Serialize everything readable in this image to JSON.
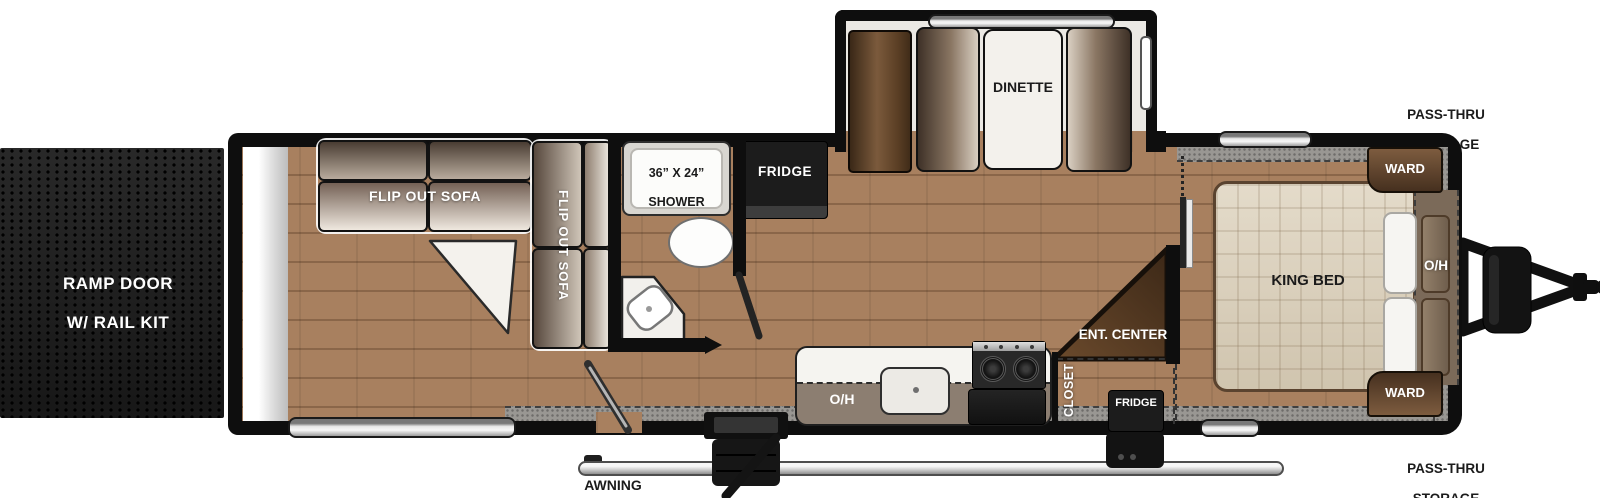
{
  "floorplan": {
    "exterior": {
      "ramp_door_line1": "RAMP DOOR",
      "ramp_door_line2": "W/ RAIL KIT",
      "awning": "AWNING",
      "pass_thru_top_line1": "PASS-THRU",
      "pass_thru_top_line2": "STORAGE",
      "pass_thru_bottom_line1": "PASS-THRU",
      "pass_thru_bottom_line2": "STORAGE"
    },
    "garage": {
      "sofa_horizontal": "FLIP OUT SOFA",
      "sofa_vertical": "FLIP OUT SOFA"
    },
    "bathroom": {
      "shower_line1": "36” X 24”",
      "shower_line2": "SHOWER"
    },
    "kitchen": {
      "fridge": "FRIDGE",
      "pantry": "PANTRY",
      "dinette": "DINETTE",
      "overhead": "O/H"
    },
    "bedroom": {
      "ent_center": "ENT. CENTER",
      "closet": "CLOSET",
      "fridge": "FRIDGE",
      "king_bed": "KING BED",
      "overhead": "O/H",
      "ward_top": "WARD",
      "ward_bottom": "WARD"
    },
    "colors": {
      "floor": "#a8805f",
      "wall": "#0e0e0e",
      "ramp_door": "#1d1d1d",
      "gray_storage_band": "#999793",
      "cabinet_brown": "#5a3e24",
      "appliance_black": "#1c1c1c",
      "bed_fabric": "#dbcfb8",
      "counter_top": "#f5f4f0",
      "overhead_cabinet": "#8c7e71",
      "window_silver": "#d9d9d9"
    }
  }
}
